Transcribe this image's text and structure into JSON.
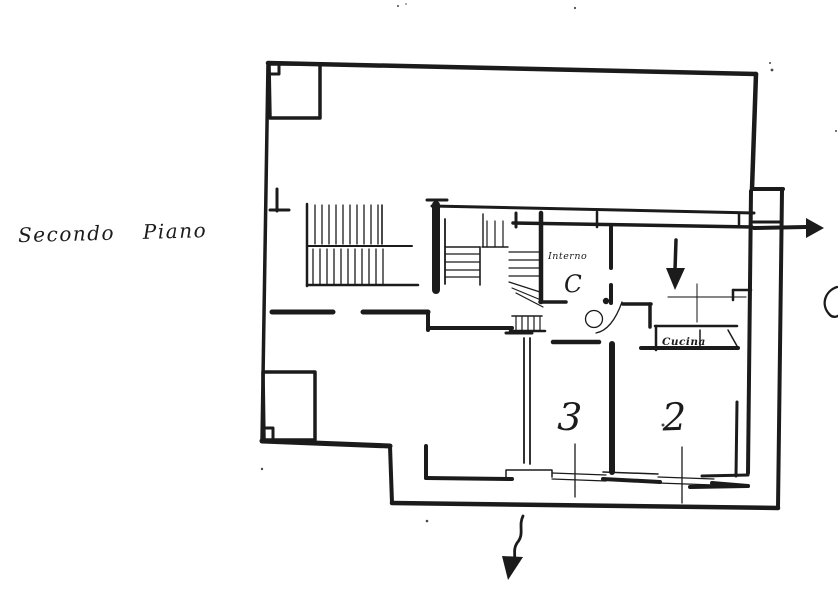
{
  "page": {
    "type": "scanned cadastral floor plan sketch",
    "background_color": "#ffffff",
    "ink_color": "#1b1b1b"
  },
  "plan": {
    "title": "Secondo Piano",
    "labels": {
      "vestibule_small": "Interno",
      "vestibule_letter": "C",
      "kitchen": "Cucina",
      "room_center": "3",
      "room_right": "2",
      "edge_letter": "C"
    },
    "icons": {
      "unit-down-arrow-icon": "▼",
      "balcony-right-arrow-icon": "▶",
      "exit-down-arrow-icon": "↓"
    }
  }
}
